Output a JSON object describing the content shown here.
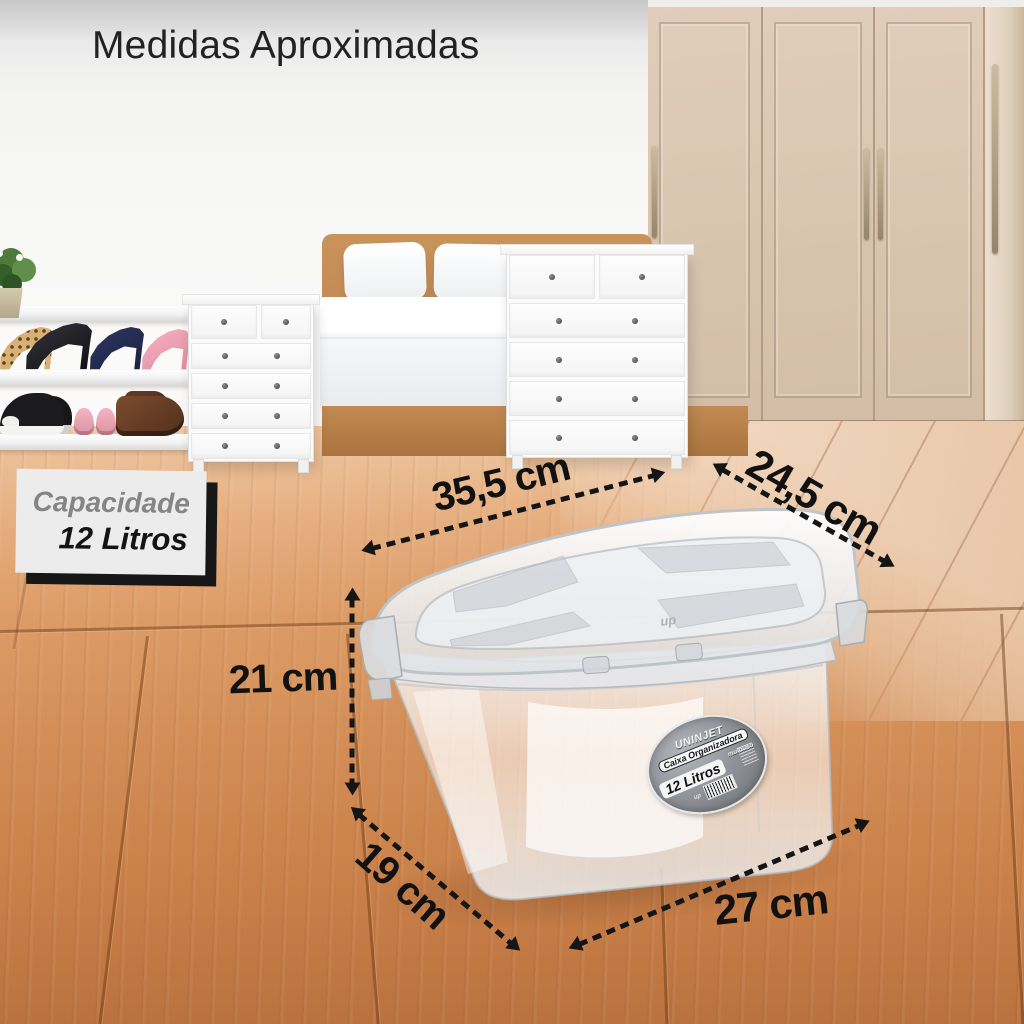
{
  "title": "Medidas Aproximadas",
  "capacity_badge": {
    "label": "Capacidade",
    "value": "12 Litros"
  },
  "measurements": {
    "lid_width": "35,5 cm",
    "lid_depth": "24,5 cm",
    "box_height": "21 cm",
    "base_depth": "19 cm",
    "base_width": "27 cm"
  },
  "product_label": {
    "brand": "UNINJET",
    "product_name": "Caixa Organizadora",
    "product_type": "multiuso",
    "capacity": "12 Litros",
    "lid_logo": "up"
  },
  "colors": {
    "annotation_text": "#151515",
    "floor_wood": "#d28c55",
    "floor_light_wood": "#eed6c0",
    "wardrobe_beige": "#d9c4af",
    "bed_frame_tan": "#c28a52",
    "badge_background": "#ececec",
    "badge_shadow": "#171717",
    "label_gray": "#8b8f94"
  }
}
